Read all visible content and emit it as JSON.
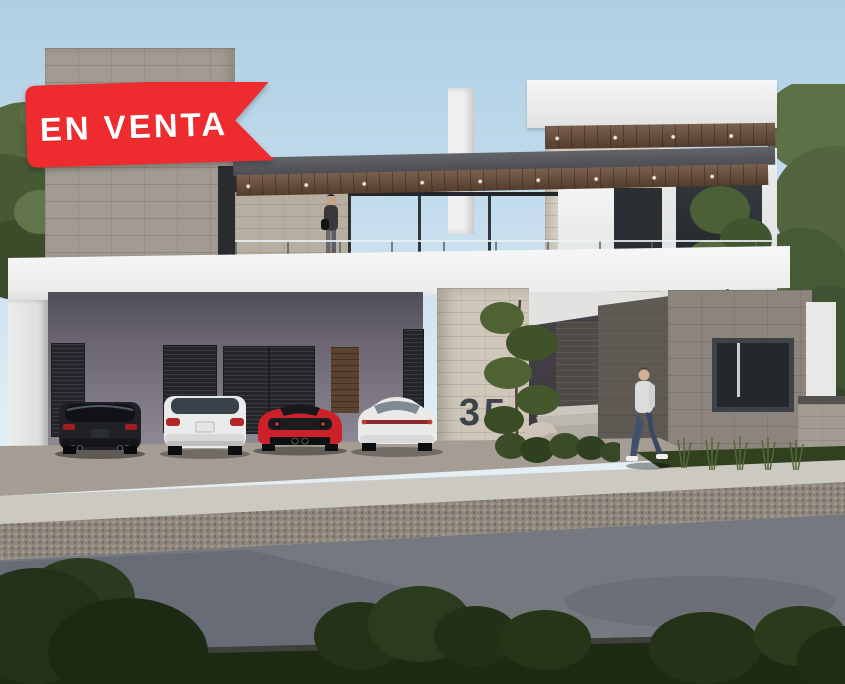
{
  "scene": {
    "kind": "exterior-3d-render",
    "description": "Modern two-story stone and white stucco house with carport, for-sale ribbon"
  },
  "banner": {
    "label": "EN VENTA",
    "bg_color": "#ee2b2e",
    "text_color": "#ffffff"
  },
  "house": {
    "number": "35",
    "number_color": "#3e4349"
  },
  "vehicles": [
    {
      "name": "dark-suv",
      "color": "#1f2125"
    },
    {
      "name": "white-suv",
      "color": "#e9eaea"
    },
    {
      "name": "red-sports-car",
      "color": "#cc2128"
    },
    {
      "name": "white-sedan",
      "color": "#e9e9e8"
    }
  ],
  "people": [
    {
      "name": "woman-on-terrace"
    },
    {
      "name": "man-walking-by-entrance"
    }
  ],
  "palette": {
    "sky": "#b7d5e8",
    "stone_light": "#a19b92",
    "stone_cream": "#d6cfc1",
    "stone_dark": "#8b857d",
    "wood_soffit": "#6b4e3a",
    "road": "#75787e",
    "lawn": "#223017",
    "white_wall": "#f2f3f2",
    "carport_wall": "#76717e"
  }
}
